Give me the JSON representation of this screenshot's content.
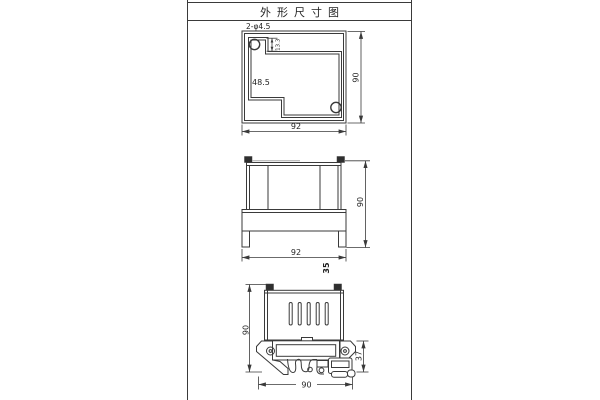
{
  "title": "外形尺寸图",
  "views": {
    "rear": {
      "hole_label": "2-φ4.5",
      "width": "92",
      "height": "90",
      "inner_offset": "48.5",
      "hole_offset": "13.3"
    },
    "front": {
      "width": "92",
      "height": "90",
      "din_rail_width": "35"
    },
    "side": {
      "height": "90",
      "rail_section_height": "37",
      "width": "90"
    }
  },
  "colors": {
    "line": "#3a3a3a",
    "text": "#1f1f1f",
    "fill_dark": "#2f2f2f",
    "background": "#ffffff"
  }
}
